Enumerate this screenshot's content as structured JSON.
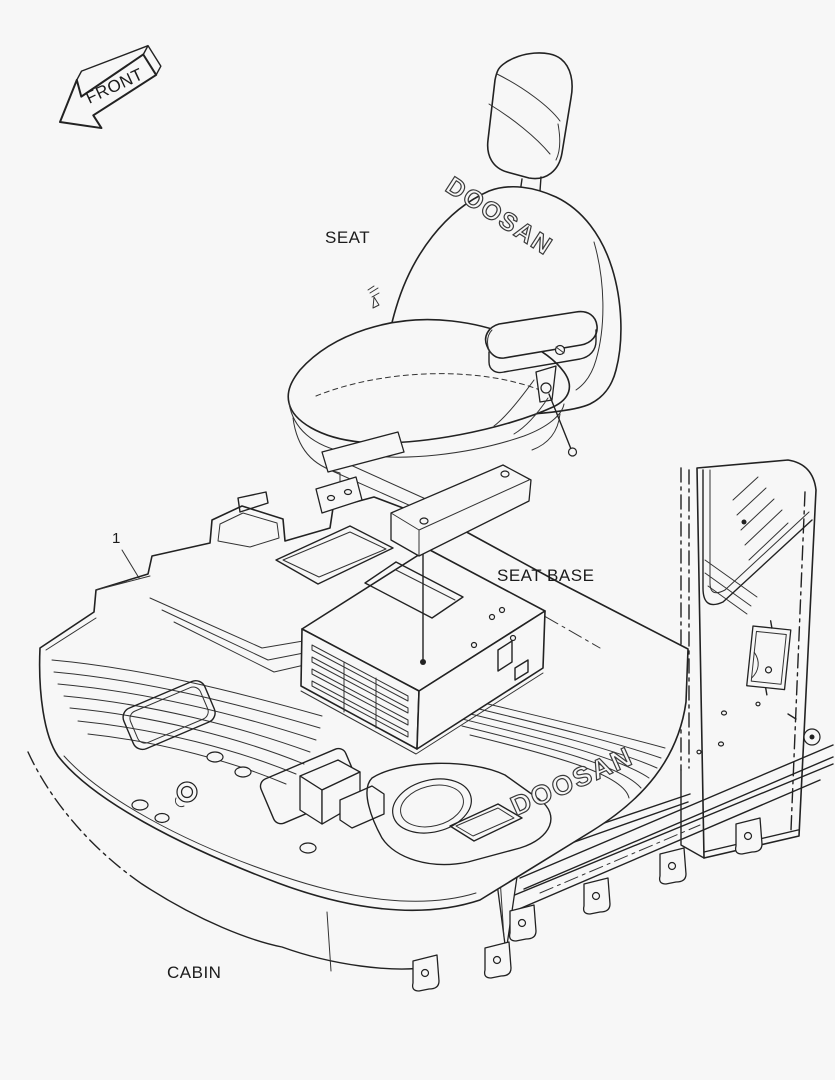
{
  "document": {
    "type": "exploded-parts-diagram",
    "background_color": "#f7f7f7",
    "line_color": "#222222"
  },
  "labels": {
    "front_arrow": "FRONT",
    "seat": "SEAT",
    "seat_base": "SEAT BASE",
    "cabin": "CABIN",
    "callout_1": "1"
  },
  "logos": {
    "seat_back": "DOOSAN",
    "floor_mat": "DOOSAN"
  }
}
